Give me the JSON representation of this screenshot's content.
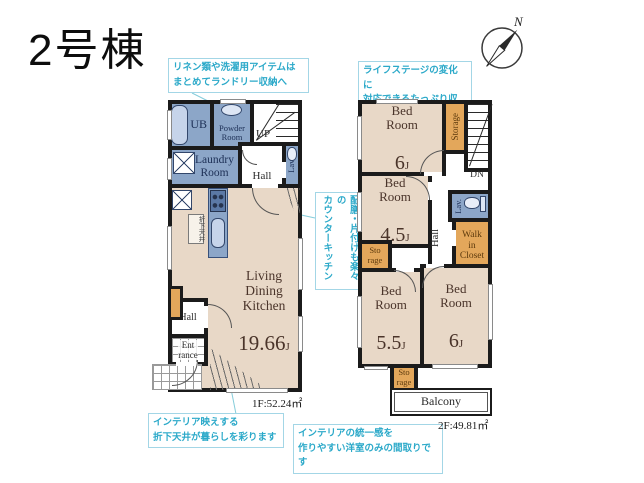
{
  "title": "2号棟",
  "compass": {
    "north_label": "N"
  },
  "notes": {
    "laundry_storage": "リネン類や洗濯用アイテムは\nまとめてランドリー収納へ",
    "life_stage": "ライフステージの変化に\n対応できるたっぷり収納",
    "counter_kitchen": "配膳・片付けも楽々の\nカウンターキッチン",
    "dropped_ceiling": "インテリア映えする\n折下天井が暮らしを彩ります",
    "unified_interior": "インテリアの統一感を\n作りやすい洋室のみの間取りです"
  },
  "floor1": {
    "area_label": "1F:52.24㎡",
    "ub": "UB",
    "powder_room": "Powder\nRoom",
    "stairs_up": "UP",
    "lavatory": "Lav.",
    "laundry_room": "Laundry\nRoom",
    "hall_upper": "Hall",
    "ldk": {
      "name": "Living\nDining\nKitchen",
      "size_num": "19.66",
      "size_unit": "J"
    },
    "dropped_ceiling_label": "折下天井",
    "hall_lower": "Hall",
    "entrance": "Ent\nrance"
  },
  "floor2": {
    "area_label": "2F:49.81㎡",
    "bed1": {
      "name": "Bed\nRoom",
      "size_num": "6",
      "size_unit": "J"
    },
    "storage_top": "Storage",
    "stairs_down": "DN",
    "bed2": {
      "name": "Bed\nRoom",
      "size_num": "4.5",
      "size_unit": "J"
    },
    "hall": "Hall",
    "lavatory": "Lav.",
    "walk_in_closet": "Walk\nin\nCloset",
    "storage_mid": "Sto\nrage",
    "bed3": {
      "name": "Bed\nRoom",
      "size_num": "5.5",
      "size_unit": "J"
    },
    "bed4": {
      "name": "Bed\nRoom",
      "size_num": "6",
      "size_unit": "J"
    },
    "storage_bottom": "Sto\nrage",
    "balcony": "Balcony"
  },
  "palette": {
    "wall": "#1b1b1b",
    "room_beige": "#e8d8c7",
    "wet_area_blue": "#8ca6c8",
    "storage_orange": "#e3a75b",
    "note_teal": "#2ba9c9"
  }
}
